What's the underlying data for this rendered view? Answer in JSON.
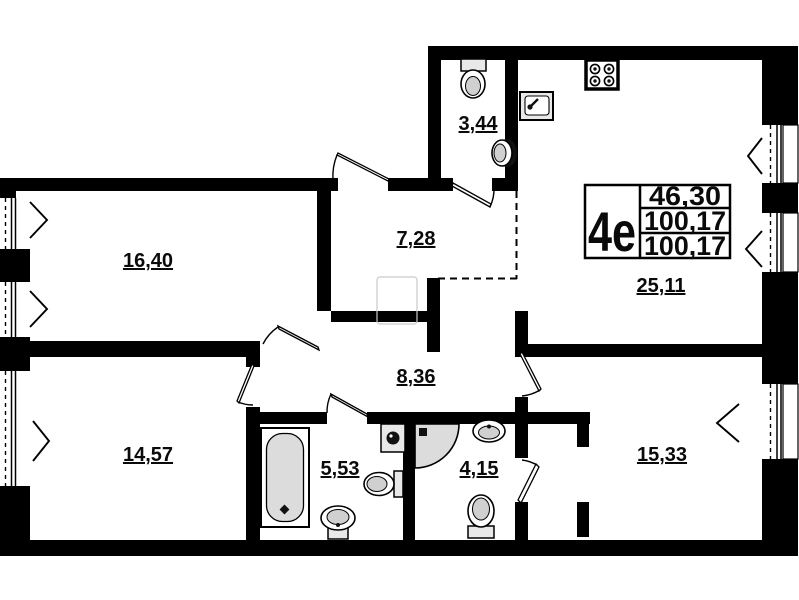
{
  "unit_info": {
    "type_label": "4e",
    "rows": [
      "46,30",
      "100,17",
      "100,17"
    ]
  },
  "rooms": {
    "room_top_left": {
      "area": "16,40"
    },
    "room_bottom_left": {
      "area": "14,57"
    },
    "hall_upper": {
      "area": "7,28"
    },
    "hall_lower": {
      "area": "8,36"
    },
    "wc_top": {
      "area": "3,44"
    },
    "kitchen_living": {
      "area": "25,11"
    },
    "bathroom": {
      "area": "5,53"
    },
    "shower_room": {
      "area": "4,15"
    },
    "room_right": {
      "area": "15,33"
    }
  },
  "fixtures": [
    "toilet",
    "washbasin",
    "kitchen-sink",
    "stove",
    "bathtub",
    "washing-machine",
    "toilet",
    "washbasin",
    "corner-shower",
    "washbasin",
    "toilet"
  ],
  "colors": {
    "wall": "#000000",
    "fixture_gray": "#dcdcdc",
    "fixture_light": "#e8e8e8",
    "bowl_gray": "#d0d0d0",
    "ghost": "#c9c9c9",
    "background": "#ffffff"
  }
}
